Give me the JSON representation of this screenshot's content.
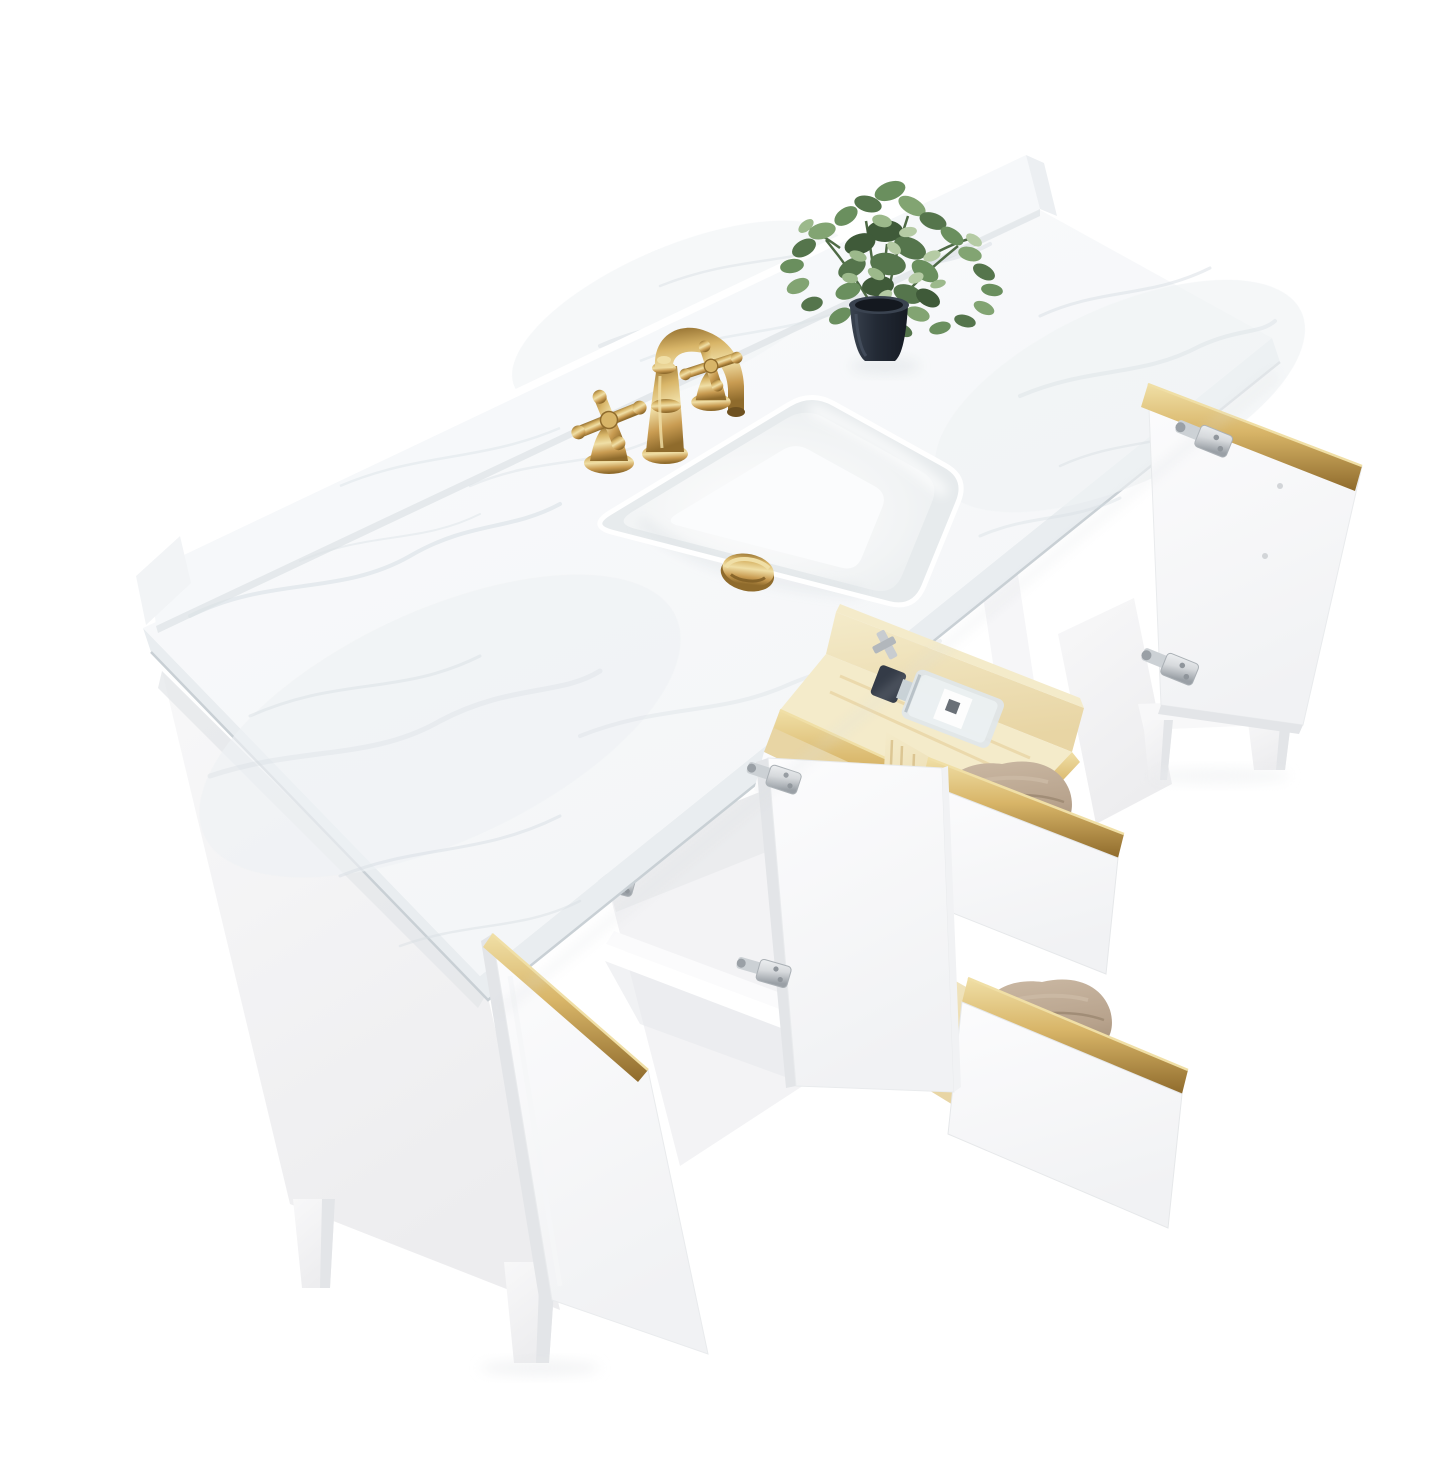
{
  "scene": {
    "type": "product-photograph",
    "caption": "White 60-inch bathroom vanity viewed from above: carrara-style white marble top with backsplash, rectangular undermount ceramic sink with brushed gold pop-up drain, brushed gold widespread faucet with two cross handles, small green artificial plant in a black pot, open white doors with gold edge trim and nickel hinges, tilt-out pine tray holding a perfume bottle, and two pulled-out pine drawers with folded taupe towels, on tapered white legs against a pure white background.",
    "background": "plain white studio cutout",
    "view": "three-quarter aerial"
  },
  "objects": {
    "countertop": "white engineered marble slab with gray veining and backsplash",
    "sink": "rectangular undermount ceramic sink",
    "drain": "brushed gold pop-up drain",
    "faucet": "brushed gold 8-inch widespread faucet, two cross handles",
    "plant": "artificial eucalyptus in matte black tapered pot",
    "left_door": "open white door with gold edge pull",
    "middle_door": "open white door with two nickel euro hinges",
    "right_door": "open white door with gold edge pull and nickel hinges",
    "tilt_tray": "pine tilt-out tray with clear perfume bottle, dark cap",
    "middle_drawer": "pine drawer, folded taupe towel, gold trim front",
    "bottom_drawer": "pine drawer, folded taupe towel, gold trim front",
    "legs": "tapered square white legs"
  },
  "colors": {
    "bg": "#ffffff",
    "marble": "#f3f5f7",
    "marble-hi": "#fafbfc",
    "vein": "#d7dee3",
    "slab-edge": "#e9edf0",
    "slab-edge-dark": "#c9d0d5",
    "splash": "#f6f8fa",
    "panel": "#f8f8f9",
    "panel-shade": "#ededef",
    "panel-deep": "#e3e5e8",
    "door": "#fcfcfd",
    "door-shade": "#f1f2f4",
    "interior": "#f3f3f5",
    "interior-shade": "#e8eaec",
    "gold": "#c99c52",
    "gold-light": "#f0dfa6",
    "gold-mid": "#d8b568",
    "gold-dark": "#8f6b2c",
    "pine": "#e8d5a4",
    "pine-light": "#f4ebca",
    "pine-dark": "#d3b87f",
    "towel": "#b7a28c",
    "towel-light": "#cbb9a4",
    "towel-dark": "#9b8770",
    "pot": "#232a35",
    "pot-light": "#3a4350",
    "soil": "#14181f",
    "leaf-1": "#3f5a39",
    "leaf-2": "#55754c",
    "leaf-3": "#6a8f5e",
    "leaf-4": "#82a472",
    "leaf-5": "#9cb98b",
    "leaf-6": "#b5cba4",
    "stem": "#4e6a45",
    "nickel": "#d6d9dc",
    "nickel-dark": "#9aa0a6",
    "bowl-shade": "#e7ebed",
    "bowl-mid": "#f2f4f5"
  }
}
